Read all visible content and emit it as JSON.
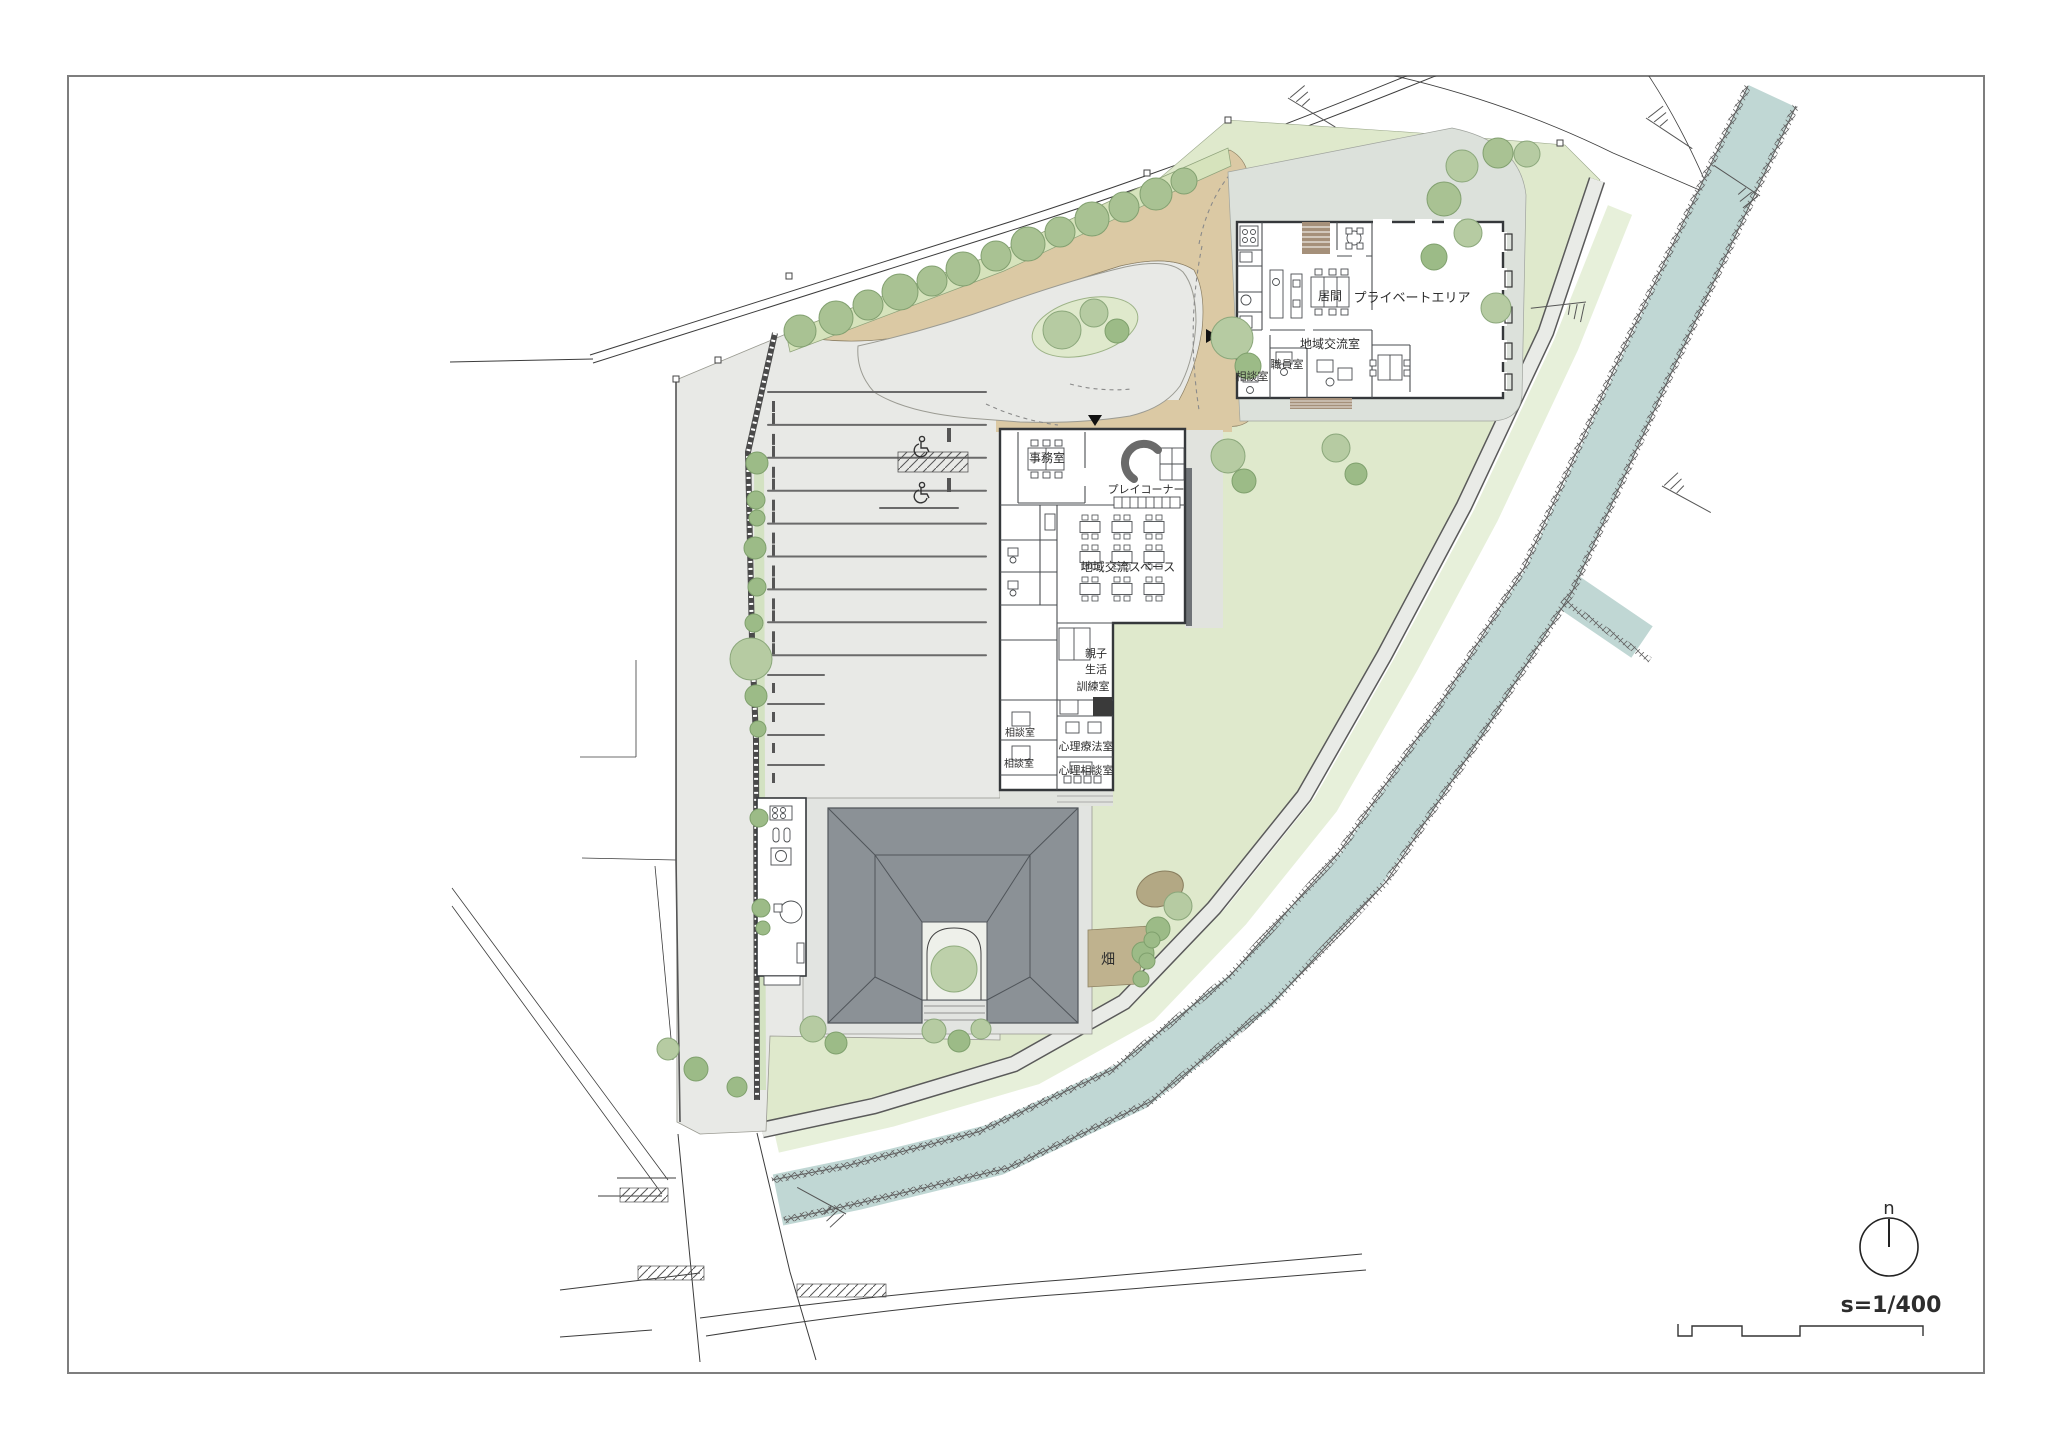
{
  "drawing": {
    "type": "architectural site plan",
    "scale_label": "s=1/400",
    "north_label": "n"
  },
  "labels": {
    "office": "事務室",
    "play_corner": "プレイコーナー",
    "community_space": "地域交流スペース",
    "training_line1": "親子",
    "training_line2": "生活",
    "training_line3": "訓練室",
    "psychotherapy_room": "心理療法室",
    "psychology_consult_room": "心理相談室",
    "consult_room_a": "相談室",
    "consult_room_b": "相談室",
    "living_room": "居間",
    "private_area": "プライベートエリア",
    "community_room": "地域交流室",
    "staff_room": "職員室",
    "consult_room_c": "相談室",
    "field": "畑"
  },
  "colors": {
    "paving": "#e8e9e6",
    "lawn": "#dfe9cc",
    "lawn_light": "#e7f0da",
    "planting_strip": "#d6e3bc",
    "path_tan": "#dbc9a4",
    "water": "#c0d7d4",
    "apron": "#dce1db",
    "roof": "#8b9196",
    "roof_line": "#50555a",
    "wall": "#35383b",
    "deck": "#a5907a",
    "field_soil": "#bfb28e",
    "mound": "#b3a884",
    "walkway": "#e9ebe7",
    "tree_greens": [
      "#a9c293",
      "#b6cba2",
      "#9cbb87",
      "#bdd0aa"
    ],
    "tree_strokes": [
      "#82a070",
      "#8ba77b",
      "#7fa06d",
      "#90ac7e"
    ]
  },
  "landscape": {
    "trees": [
      [
        800,
        331,
        16,
        0
      ],
      [
        836,
        318,
        17,
        0
      ],
      [
        868,
        305,
        15,
        0
      ],
      [
        900,
        292,
        18,
        0
      ],
      [
        932,
        281,
        15,
        0
      ],
      [
        963,
        269,
        17,
        0
      ],
      [
        996,
        256,
        15,
        0
      ],
      [
        1028,
        244,
        17,
        0
      ],
      [
        1060,
        232,
        15,
        0
      ],
      [
        1092,
        219,
        17,
        0
      ],
      [
        1124,
        207,
        15,
        0
      ],
      [
        1156,
        194,
        16,
        0
      ],
      [
        1184,
        181,
        13,
        0
      ],
      [
        1462,
        166,
        16,
        1
      ],
      [
        1498,
        153,
        15,
        0
      ],
      [
        1527,
        154,
        13,
        1
      ],
      [
        1444,
        199,
        17,
        0
      ],
      [
        1468,
        233,
        14,
        1
      ],
      [
        1434,
        257,
        13,
        2
      ],
      [
        1496,
        308,
        15,
        1
      ],
      [
        1336,
        448,
        14,
        1
      ],
      [
        1356,
        474,
        11,
        2
      ],
      [
        1232,
        338,
        21,
        1
      ],
      [
        1248,
        366,
        13,
        2
      ],
      [
        1228,
        456,
        17,
        1
      ],
      [
        1244,
        481,
        12,
        2
      ],
      [
        1178,
        906,
        14,
        1
      ],
      [
        1158,
        929,
        12,
        2
      ],
      [
        1143,
        953,
        11,
        2
      ],
      [
        1152,
        940,
        8,
        2
      ],
      [
        1147,
        961,
        8,
        2
      ],
      [
        1141,
        979,
        8,
        2
      ],
      [
        813,
        1029,
        13,
        1
      ],
      [
        836,
        1043,
        11,
        2
      ],
      [
        934,
        1031,
        12,
        1
      ],
      [
        959,
        1041,
        11,
        2
      ],
      [
        981,
        1029,
        10,
        1
      ],
      [
        668,
        1049,
        11,
        1
      ],
      [
        696,
        1069,
        12,
        2
      ],
      [
        737,
        1087,
        10,
        2
      ],
      [
        757,
        463,
        11,
        2
      ],
      [
        756,
        500,
        9,
        2
      ],
      [
        757,
        518,
        8,
        2
      ],
      [
        755,
        548,
        11,
        2
      ],
      [
        757,
        587,
        9,
        2
      ],
      [
        754,
        623,
        9,
        2
      ],
      [
        751,
        659,
        21,
        1
      ],
      [
        756,
        696,
        11,
        2
      ],
      [
        758,
        729,
        8,
        2
      ],
      [
        759,
        818,
        9,
        2
      ],
      [
        761,
        908,
        9,
        2
      ],
      [
        763,
        928,
        7,
        2
      ],
      [
        1062,
        330,
        19,
        1
      ],
      [
        1094,
        313,
        14,
        1
      ],
      [
        1117,
        331,
        12,
        2
      ],
      [
        954,
        969,
        23,
        3
      ]
    ]
  },
  "parking": {
    "long_rows": 9,
    "long_x1": 768,
    "long_x2": 986,
    "long_y0": 392,
    "long_dy": 32.9,
    "short_ys": [
      675,
      704,
      735,
      765
    ],
    "short_x1": 768,
    "short_x2": 824,
    "stop_x": 772
  },
  "community_tables": {
    "cols": [
      1090,
      1122,
      1154
    ],
    "rows": [
      527,
      557,
      589
    ]
  }
}
